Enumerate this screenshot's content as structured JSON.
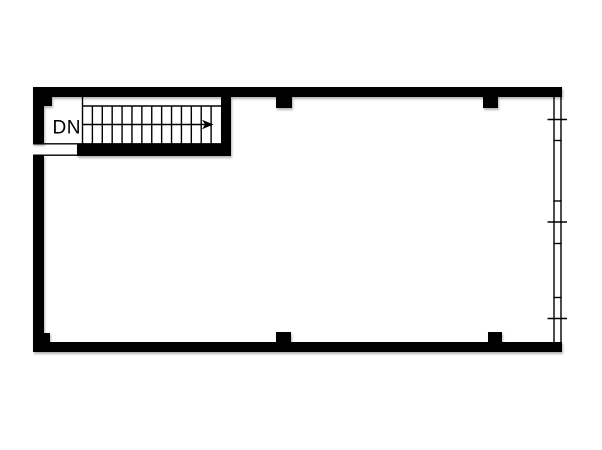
{
  "floorplan": {
    "background_color": "#ffffff",
    "wall_color": "#000000",
    "stair": {
      "direction_label": "DN",
      "arrow_direction": "right",
      "tread_line_count": 13
    },
    "left_wall": {
      "doorway_opening": true
    },
    "window_wall": {
      "side": "right",
      "major_tick_count": 3,
      "minor_tick_count": 4
    },
    "column_marker_count": 6
  }
}
